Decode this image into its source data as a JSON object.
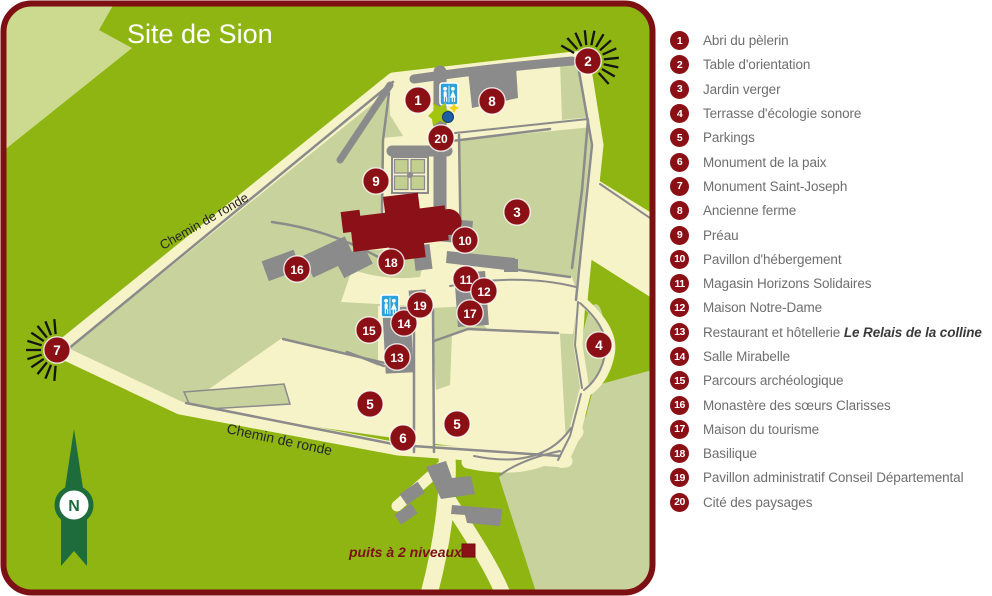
{
  "title": "Site de Sion",
  "map": {
    "labels": {
      "chemin_upper": "Chemin de ronde",
      "chemin_lower": "Chemin de ronde",
      "puits": "puits à 2 niveaux",
      "compass_letter": "N"
    },
    "markers": [
      {
        "n": "1",
        "x": 418,
        "y": 100
      },
      {
        "n": "2",
        "x": 588,
        "y": 61
      },
      {
        "n": "3",
        "x": 517,
        "y": 212
      },
      {
        "n": "4",
        "x": 599,
        "y": 345
      },
      {
        "n": "5",
        "x": 370,
        "y": 404
      },
      {
        "n": "5",
        "x": 457,
        "y": 424
      },
      {
        "n": "6",
        "x": 403,
        "y": 438
      },
      {
        "n": "7",
        "x": 57,
        "y": 350
      },
      {
        "n": "8",
        "x": 492,
        "y": 101
      },
      {
        "n": "9",
        "x": 376,
        "y": 181
      },
      {
        "n": "10",
        "x": 465,
        "y": 240
      },
      {
        "n": "11",
        "x": 466,
        "y": 279
      },
      {
        "n": "12",
        "x": 484,
        "y": 291
      },
      {
        "n": "13",
        "x": 397,
        "y": 357
      },
      {
        "n": "14",
        "x": 404,
        "y": 323
      },
      {
        "n": "15",
        "x": 369,
        "y": 330
      },
      {
        "n": "16",
        "x": 297,
        "y": 269
      },
      {
        "n": "17",
        "x": 470,
        "y": 313
      },
      {
        "n": "18",
        "x": 391,
        "y": 262
      },
      {
        "n": "19",
        "x": 420,
        "y": 305
      },
      {
        "n": "20",
        "x": 441,
        "y": 138
      }
    ],
    "sunbursts": [
      {
        "marker": "7",
        "x": 57,
        "y": 350,
        "start": 95,
        "end": 265,
        "rays": 11
      },
      {
        "marker": "2",
        "x": 588,
        "y": 61,
        "start": 150,
        "end": -48,
        "rays": 12
      }
    ],
    "colors": {
      "background_green": "#8eb511",
      "light_green": "#ccda90",
      "sage_green": "#c8d29c",
      "path_cream": "#f7f3c8",
      "path_gray": "#8b8b8b",
      "marker_red": "#8b1016",
      "border_red": "#7c1013",
      "basilica_red": "#8c1018",
      "compass_green": "#1e6b3c",
      "wc_blue": "#2ba0da"
    }
  },
  "legend": {
    "items": [
      {
        "n": "1",
        "label": "Abri du pèlerin"
      },
      {
        "n": "2",
        "label": "Table d'orientation"
      },
      {
        "n": "3",
        "label": "Jardin verger"
      },
      {
        "n": "4",
        "label": "Terrasse d'écologie sonore"
      },
      {
        "n": "5",
        "label": "Parkings"
      },
      {
        "n": "6",
        "label": "Monument de la paix"
      },
      {
        "n": "7",
        "label": "Monument Saint-Joseph"
      },
      {
        "n": "8",
        "label": "Ancienne ferme"
      },
      {
        "n": "9",
        "label": "Préau"
      },
      {
        "n": "10",
        "label": "Pavillon d'hébergement"
      },
      {
        "n": "11",
        "label": "Magasin Horizons Solidaires"
      },
      {
        "n": "12",
        "label": "Maison Notre-Dame"
      },
      {
        "n": "13",
        "label": "Restaurant et hôtellerie",
        "emphasis": "Le Relais de la colline"
      },
      {
        "n": "14",
        "label": "Salle Mirabelle"
      },
      {
        "n": "15",
        "label": "Parcours archéologique"
      },
      {
        "n": "16",
        "label": "Monastère des sœurs Clarisses"
      },
      {
        "n": "17",
        "label": "Maison du tourisme"
      },
      {
        "n": "18",
        "label": "Basilique"
      },
      {
        "n": "19",
        "label": "Pavillon administratif Conseil Départemental"
      },
      {
        "n": "20",
        "label": "Cité des paysages"
      }
    ]
  }
}
